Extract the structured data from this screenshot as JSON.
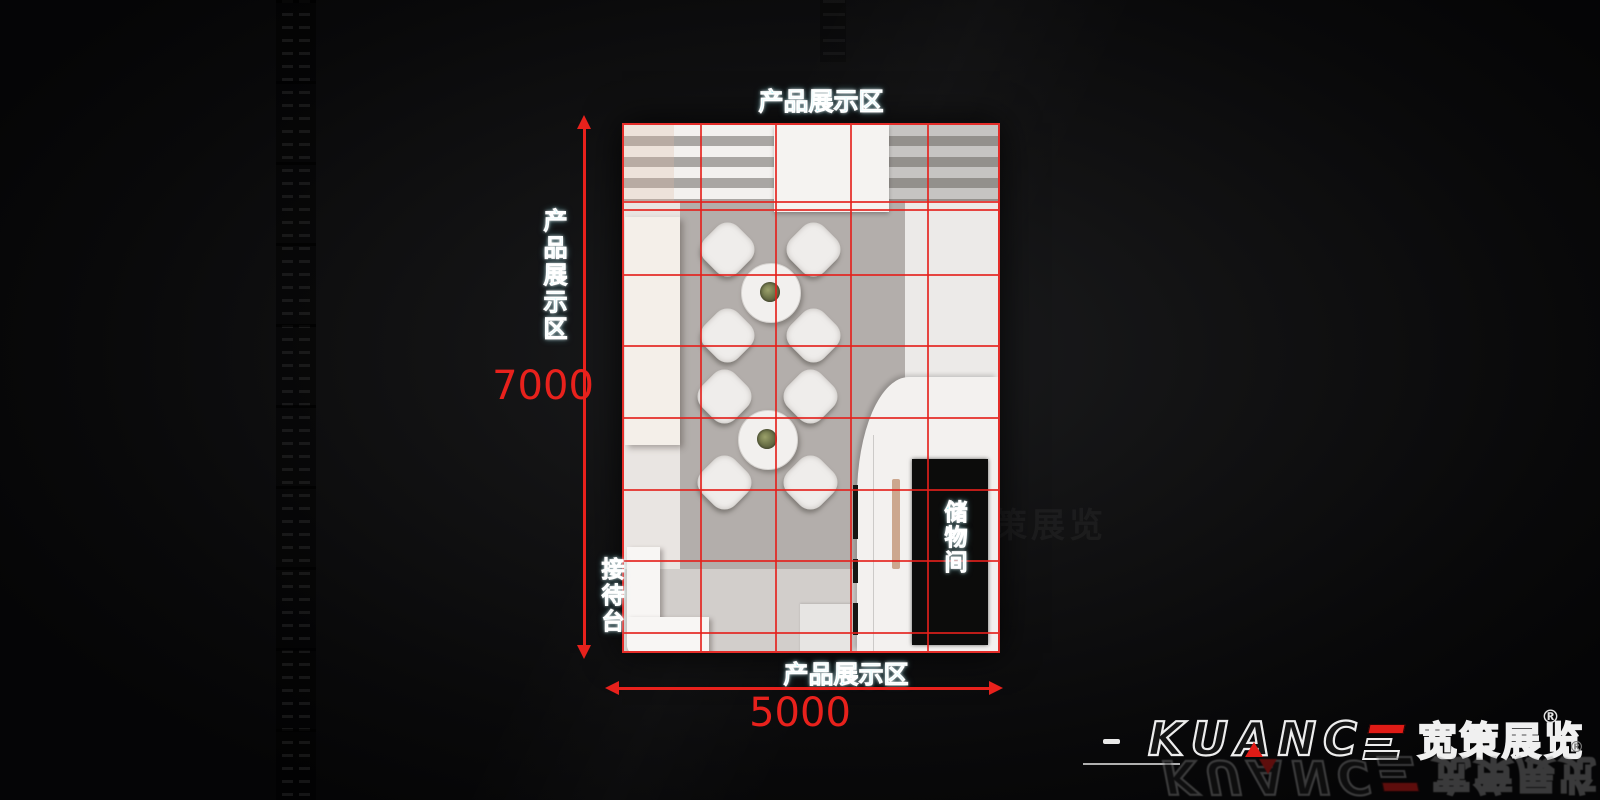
{
  "plan": {
    "top_label": "产品展示区",
    "left_label": "产品展示区",
    "bottom_label": "产品展示区",
    "reception_label": "接待台",
    "storage_label": "储物间",
    "height_dim": "7000",
    "width_dim": "5000"
  },
  "logo": {
    "letters": [
      "K",
      "U",
      "A",
      "N",
      "C"
    ],
    "brand_cn": "宽策展览",
    "registered": "®",
    "registered_secondary": "®"
  },
  "colors": {
    "dimension_red": "#e8211c",
    "grid_red": "#e42320",
    "label_cyan": "#8ceef7",
    "logo_red": "#e01b16",
    "floor_gray": "#b3aeab"
  }
}
